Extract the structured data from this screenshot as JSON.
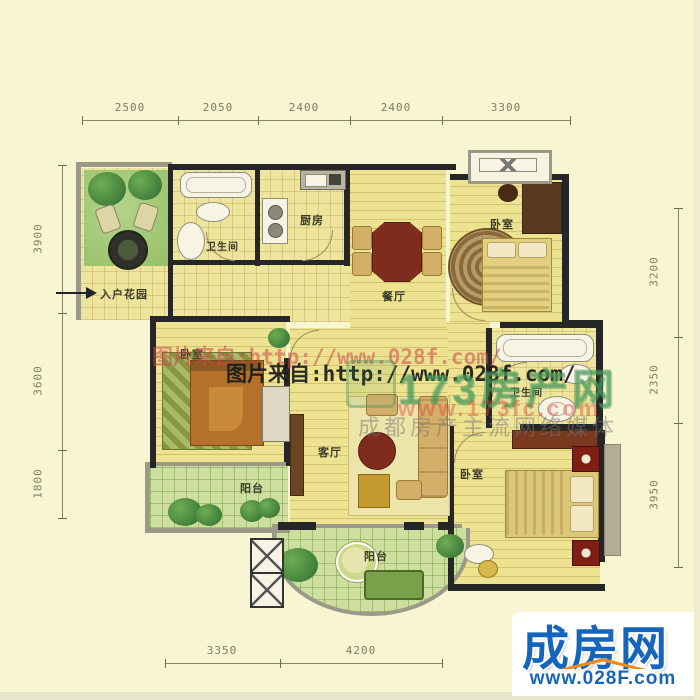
{
  "dimensions": {
    "top": [
      "2500",
      "2050",
      "2400",
      "2400",
      "3300"
    ],
    "left": [
      "3900",
      "3600",
      "1800"
    ],
    "right": [
      "3200",
      "2350",
      "3950"
    ],
    "bottom": [
      "3350",
      "4200"
    ]
  },
  "rooms": {
    "garden": "入户花园",
    "bath1": "卫生间",
    "kitchen": "厨房",
    "dining": "餐厅",
    "bed1": "卧室",
    "bath2": "卫生间",
    "bed2": "卧室",
    "living": "客厅",
    "bed3": "卧室",
    "balcony1": "阳台",
    "balcony2": "阳台"
  },
  "watermarks": {
    "credit_red": "图片来自:http://www.028f.com/",
    "credit_black": "图片来自:http://www.028f.com/",
    "logo_text": "173房产网",
    "logo_url": "www.173fc.com",
    "tagline": "成都房产主流网络媒体"
  },
  "footer": {
    "brand": "成房网",
    "url": "www.028F.com"
  },
  "colors": {
    "wall": "#262626",
    "brand_blue": "#1565bd",
    "accent_orange": "#f08a1d",
    "credit_red": "#c84b4b",
    "floor_yellow": "#ece28f",
    "green": "#a4c878"
  }
}
